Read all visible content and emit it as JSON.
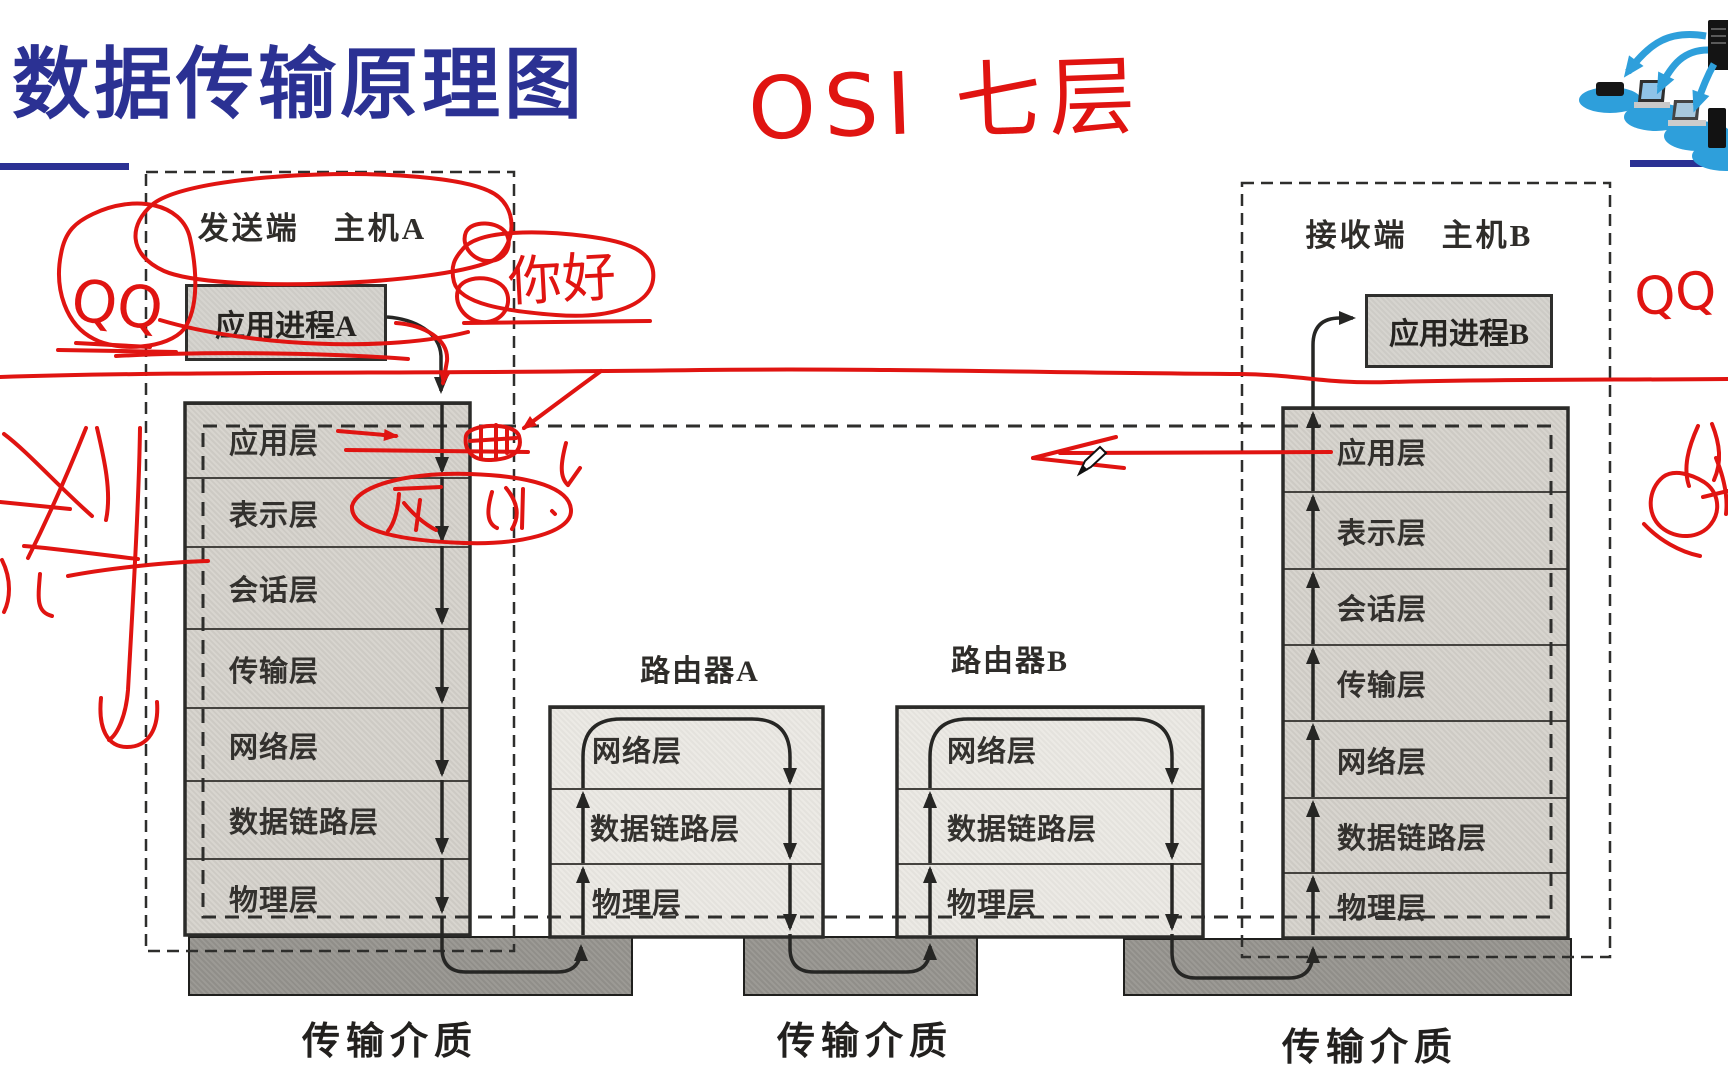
{
  "title": "数据传输原理图",
  "colors": {
    "title_blue": "#2b3193",
    "annotation_red": "#e01411",
    "host_fill": "#d8d5cf",
    "router_fill": "#eceae5",
    "medium_fill": "#9c9a95",
    "icon_blue": "#2e9fdb"
  },
  "handwriting": {
    "osi_note": "OSI 七层",
    "qq_left": "QQ",
    "qq_right": "QQ",
    "greeting": "你好"
  },
  "left_host": {
    "header": "发送端　主机A",
    "process_box": "应用进程A",
    "layers": [
      "应用层",
      "表示层",
      "会话层",
      "传输层",
      "网络层",
      "数据链路层",
      "物理层"
    ]
  },
  "right_host": {
    "header": "接收端　主机B",
    "process_box": "应用进程B",
    "layers": [
      "应用层",
      "表示层",
      "会话层",
      "传输层",
      "网络层",
      "数据链路层",
      "物理层"
    ]
  },
  "router_a": {
    "title": "路由器A",
    "layers": [
      "网络层",
      "数据链路层",
      "物理层"
    ]
  },
  "router_b": {
    "title": "路由器B",
    "layers": [
      "网络层",
      "数据链路层",
      "物理层"
    ]
  },
  "media_labels": {
    "left": "传输介质",
    "middle": "传输介质",
    "right": "传输介质"
  }
}
